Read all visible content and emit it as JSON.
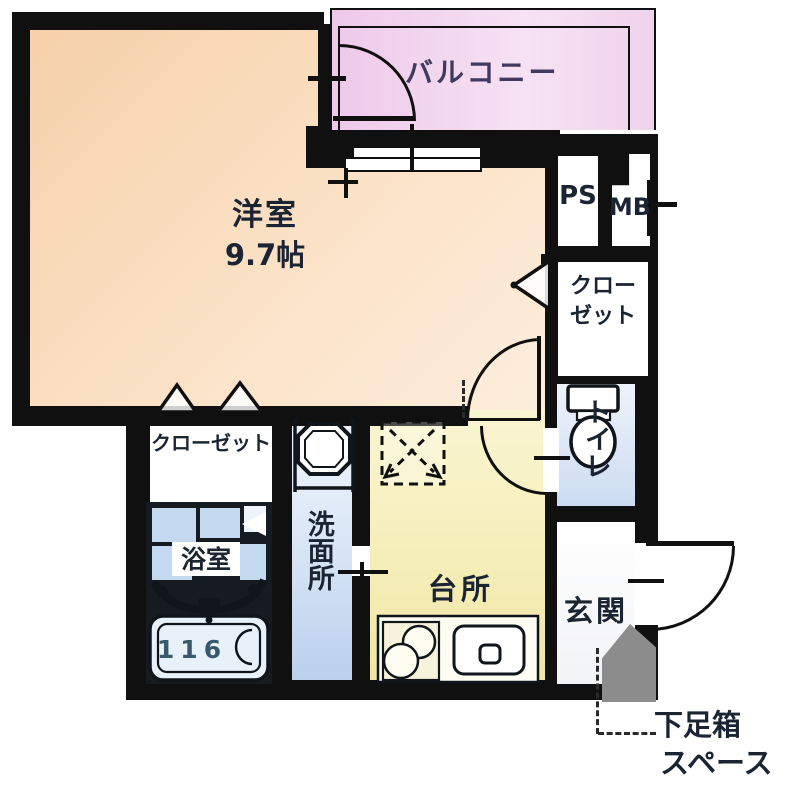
{
  "title": "apartment-floor-plan",
  "rooms": {
    "western": {
      "label": "洋室",
      "size": "9.7帖"
    },
    "balcony": {
      "label": "バルコニー"
    },
    "ps": {
      "label": "PS"
    },
    "mb": {
      "label": "MB"
    },
    "closet_right": {
      "line1": "クロー",
      "line2": "ゼット"
    },
    "toilet": {
      "label": "トイレ"
    },
    "closet_left": {
      "label": "クローゼット"
    },
    "bath": {
      "label": "浴室",
      "tub_size": "116"
    },
    "washroom": {
      "label": "洗面所"
    },
    "kitchen": {
      "label": "台所"
    },
    "entrance": {
      "label": "玄関"
    }
  },
  "annotations": {
    "shoe_box": {
      "line1": "下足箱",
      "line2": "スペース"
    }
  },
  "icons": [
    "toilet-icon",
    "washbasin-icon",
    "bathtub-icon",
    "stove-icon",
    "kitchen-sink-icon",
    "fridge-space-icon",
    "folding-door-icon",
    "closet-door-chevron-icon",
    "sliding-window-icon",
    "door-swing-arc"
  ],
  "colors": {
    "wall": "#101010",
    "western_room": "#f8d9ba",
    "balcony": "#f0cfec",
    "kitchen": "#f5eeb8",
    "washroom": "#cfdff2",
    "toilet": "#dde9f7",
    "bath_tile": "#c2d9f0",
    "shoe_space_gray": "#8c8c8c",
    "text": "#1b2433"
  }
}
